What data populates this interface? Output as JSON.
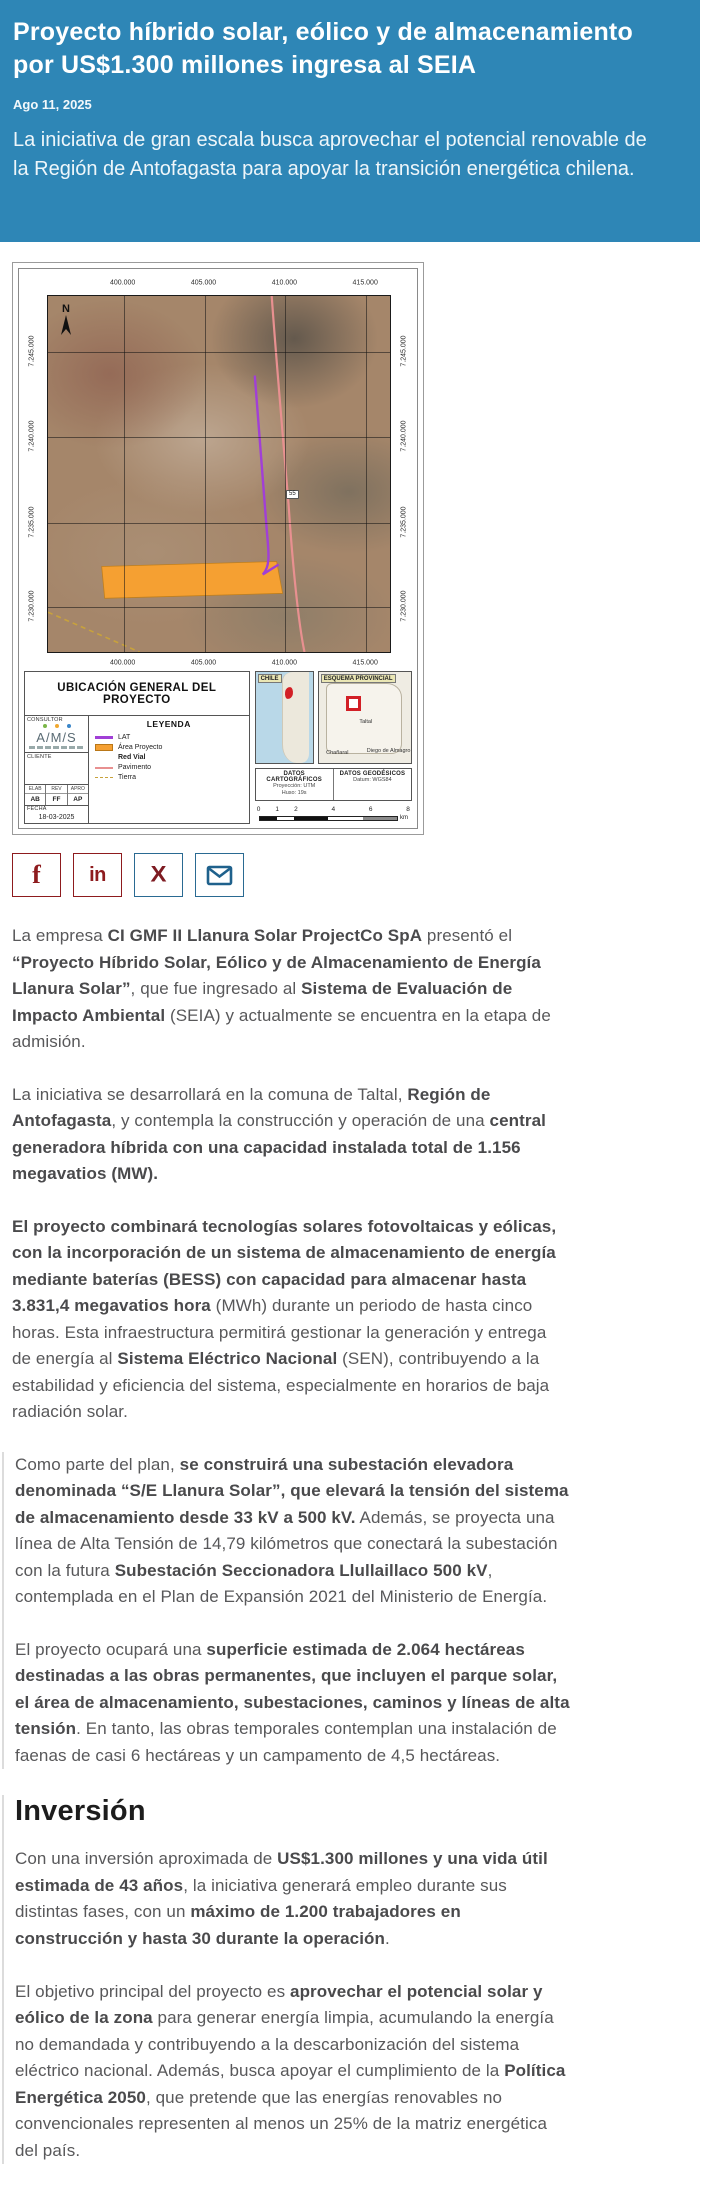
{
  "header": {
    "background_color": "#2e86b6",
    "title": "Proyecto híbrido solar, eólico y de almacenamiento por US$1.300 millones ingresa al SEIA",
    "date": "Ago 11, 2025",
    "subtitle": "La iniciativa de gran escala busca aprovechar el potencial renovable de la Región de Antofagasta para apoyar la transición energética chilena."
  },
  "map": {
    "sheet_title": "UBICACIÓN GENERAL DEL PROYECTO",
    "north_label": "N",
    "route_chip": "55",
    "colors": {
      "lat_line": "#a13fd6",
      "paved_road": "#e89090",
      "dirt_road": "#c8a23c",
      "project_area": "#f5a032"
    },
    "coords": {
      "top": [
        "400.000",
        "405.000",
        "410.000",
        "415.000"
      ],
      "bottom": [
        "400.000",
        "405.000",
        "410.000",
        "415.000"
      ],
      "left": [
        "7.245.000",
        "7.240.000",
        "7.235.000",
        "7.230.000"
      ],
      "right": [
        "7.245.000",
        "7.240.000",
        "7.235.000",
        "7.230.000"
      ]
    },
    "consultor": {
      "label": "CONSULTOR",
      "logo": "A/M/S",
      "cliente_label": "CLIENTE",
      "table_headers": [
        "ELAB",
        "REV",
        "APRO"
      ],
      "table_values": [
        "AB",
        "FF",
        "AP"
      ],
      "fecha_label": "FECHA",
      "fecha_value": "18-03-2025"
    },
    "legend": {
      "title": "LEYENDA",
      "items": [
        {
          "label": "LAT",
          "swatch": "purple-line",
          "header": false
        },
        {
          "label": "Área Proyecto",
          "swatch": "orange-box",
          "header": false
        },
        {
          "label": "Red Vial",
          "swatch": "none",
          "header": true
        },
        {
          "label": "Pavimento",
          "swatch": "pink-line",
          "header": false
        },
        {
          "label": "Tierra",
          "swatch": "dash-line",
          "header": false
        }
      ]
    },
    "insets": {
      "chile_label": "CHILE",
      "provincial_label": "ESQUEMA PROVINCIAL",
      "provincial_places": [
        "Taltal",
        "Chañaral",
        "Diego de Almagro"
      ]
    },
    "datos": {
      "cart_title": "DATOS CARTOGRÁFICOS",
      "cart_line1": "Proyección: UTM",
      "cart_line2": "Huso: 19s",
      "geo_title": "DATOS GEODÉSICOS",
      "geo_line1": "Datum: WGS84"
    },
    "scalebar": {
      "ticks": [
        "0",
        "1",
        "2",
        "4",
        "6",
        "8"
      ],
      "tick_fractions": [
        0,
        0.125,
        0.25,
        0.5,
        0.75,
        1
      ],
      "segments": [
        {
          "width": 12.5,
          "color": "#111111"
        },
        {
          "width": 12.5,
          "color": "#ffffff"
        },
        {
          "width": 25,
          "color": "#111111"
        },
        {
          "width": 25,
          "color": "#ffffff"
        },
        {
          "width": 25,
          "color": "#8a8a8a"
        }
      ],
      "unit": "km"
    }
  },
  "share": {
    "buttons": [
      {
        "name": "facebook",
        "glyph": "f",
        "border_color": "#8e1b1e",
        "glyph_color": "#8e1b1e"
      },
      {
        "name": "linkedin",
        "glyph": "in",
        "border_color": "#8e1b1e",
        "glyph_color": "#8e1b1e"
      },
      {
        "name": "x",
        "glyph": "X",
        "border_color": "#2a6a92",
        "glyph_color": "#7e1b22"
      },
      {
        "name": "email",
        "glyph": "envelope",
        "border_color": "#2a6a92",
        "glyph_color": "#1f618c"
      }
    ]
  },
  "article": {
    "sections": [
      {
        "bordered": false,
        "blocks": [
          {
            "type": "p",
            "segments": [
              {
                "text": "La empresa ",
                "bold": false
              },
              {
                "text": "CI GMF II Llanura Solar ProjectCo SpA",
                "bold": true
              },
              {
                "text": " presentó el ",
                "bold": false
              },
              {
                "text": "“Proyecto Híbrido Solar, Eólico y de Almacenamiento de Energía Llanura Solar”",
                "bold": true
              },
              {
                "text": ", que fue ingresado al ",
                "bold": false
              },
              {
                "text": "Sistema de Evaluación de Impacto Ambiental",
                "bold": true
              },
              {
                "text": " (SEIA) y actualmente se encuentra en la etapa de admisión.",
                "bold": false
              }
            ]
          },
          {
            "type": "p",
            "segments": [
              {
                "text": "La iniciativa se desarrollará en la comuna de Taltal, ",
                "bold": false
              },
              {
                "text": "Región de Antofagasta",
                "bold": true
              },
              {
                "text": ", y contempla la construcción y operación de una ",
                "bold": false
              },
              {
                "text": "central generadora híbrida con una capacidad instalada total de 1.156 megavatios (MW).",
                "bold": true
              }
            ]
          },
          {
            "type": "p",
            "segments": [
              {
                "text": "El proyecto combinará tecnologías solares fotovoltaicas y eólicas, con la incorporación de un sistema de almacenamiento de energía mediante baterías (BESS) con capacidad para almacenar hasta 3.831,4 megavatios hora",
                "bold": true
              },
              {
                "text": " (MWh) durante un periodo de hasta cinco horas. Esta infraestructura permitirá gestionar la generación y entrega de energía al ",
                "bold": false
              },
              {
                "text": "Sistema Eléctrico Nacional",
                "bold": true
              },
              {
                "text": " (SEN), contribuyendo a la estabilidad y eficiencia del sistema, especialmente en horarios de baja radiación solar.",
                "bold": false
              }
            ]
          }
        ]
      },
      {
        "bordered": true,
        "blocks": [
          {
            "type": "p",
            "segments": [
              {
                "text": "Como parte del plan, ",
                "bold": false
              },
              {
                "text": "se construirá una subestación elevadora denominada “S/E Llanura Solar”, que elevará la tensión del sistema de almacenamiento desde 33 kV a 500 kV.",
                "bold": true
              },
              {
                "text": " Además, se proyecta una línea de Alta Tensión de 14,79 kilómetros que conectará la subestación con la futura ",
                "bold": false
              },
              {
                "text": "Subestación Seccionadora Llullaillaco 500 kV",
                "bold": true
              },
              {
                "text": ", contemplada en el Plan de Expansión 2021 del Ministerio de Energía.",
                "bold": false
              }
            ]
          },
          {
            "type": "p",
            "segments": [
              {
                "text": "El proyecto ocupará una ",
                "bold": false
              },
              {
                "text": "superficie estimada de 2.064 hectáreas destinadas a las obras permanentes, que incluyen el parque solar, el área de almacenamiento, subestaciones, caminos y líneas de alta tensión",
                "bold": true
              },
              {
                "text": ". En tanto, las obras temporales contemplan una instalación de faenas de casi 6 hectáreas y un campamento de 4,5 hectáreas.",
                "bold": false
              }
            ]
          }
        ]
      },
      {
        "bordered": true,
        "blocks": [
          {
            "type": "h2",
            "text": "Inversión"
          },
          {
            "type": "p",
            "segments": [
              {
                "text": "Con una inversión aproximada de ",
                "bold": false
              },
              {
                "text": "US$1.300 millones y una vida útil estimada de 43 años",
                "bold": true
              },
              {
                "text": ", la iniciativa generará empleo durante sus distintas fases, con un ",
                "bold": false
              },
              {
                "text": "máximo de 1.200 trabajadores en construcción y hasta 30 durante la operación",
                "bold": true
              },
              {
                "text": ".",
                "bold": false
              }
            ]
          },
          {
            "type": "p",
            "segments": [
              {
                "text": "El objetivo principal del proyecto es ",
                "bold": false
              },
              {
                "text": "aprovechar el potencial solar y eólico de la zona",
                "bold": true
              },
              {
                "text": " para generar energía limpia, acumulando la energía no demandada y contribuyendo a la descarbonización del sistema eléctrico nacional. Además, busca apoyar el cumplimiento de la ",
                "bold": false
              },
              {
                "text": "Política Energética 2050",
                "bold": true
              },
              {
                "text": ", que pretende que las energías renovables no convencionales representen al menos un 25% de la matriz energética del país.",
                "bold": false
              }
            ]
          }
        ]
      }
    ]
  }
}
